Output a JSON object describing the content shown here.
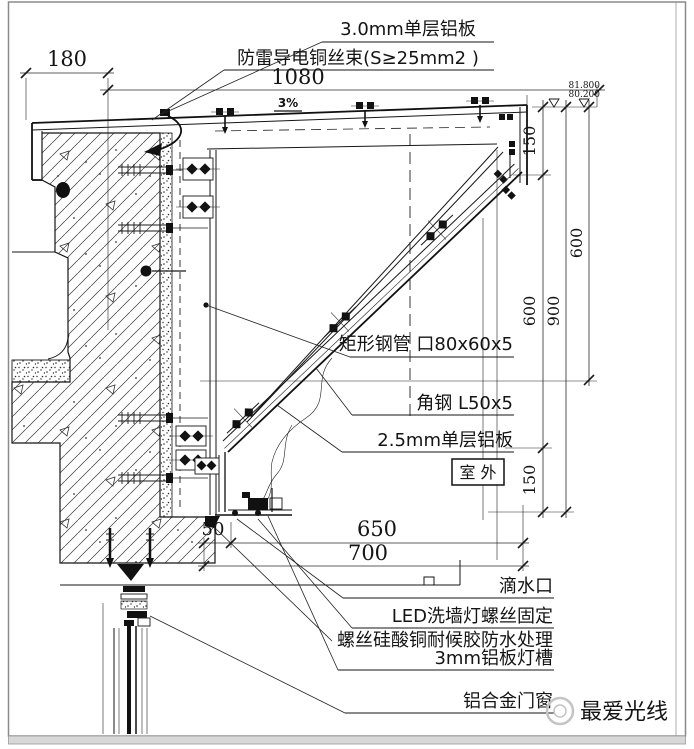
{
  "labels": {
    "panel_3_0mm": "3.0mm单层铝板",
    "lightning_wire": "防雷导电铜丝束(S≥25mm2 )",
    "rect_steel_tube": "矩形钢管 口80x60x5",
    "angle_steel": "角钢 L50x5",
    "panel_2_5mm": "2.5mm单层铝板",
    "outdoor": "室 外",
    "drip_outlet": "滴水口",
    "led_fixing": "LED洗墙灯螺丝固定",
    "sealant_treatment": "螺丝硅酸铜耐候胶防水处理",
    "lamp_trough": "3mm铝板灯槽",
    "aluminum_door_window": "铝合金门窗",
    "slope": "3%"
  },
  "dimensions": {
    "top_offset": "180",
    "top_width": "1080",
    "right_top": "150",
    "right_inner_mid": "600",
    "right_bottom": "150",
    "right_total": "900",
    "right_outer": "600",
    "bottom_inner": "650",
    "bottom_outer": "700",
    "drip_offset": "50",
    "elevation_upper": "81.800",
    "elevation_lower": "80.200"
  },
  "watermark": {
    "text": "最爱光线",
    "icon": "flower-logo-icon"
  },
  "colors": {
    "line": "#161616",
    "page_border": "#8a8a8a",
    "bottom_band": "#d8d8d8",
    "watermark": "#c4c4c4"
  }
}
